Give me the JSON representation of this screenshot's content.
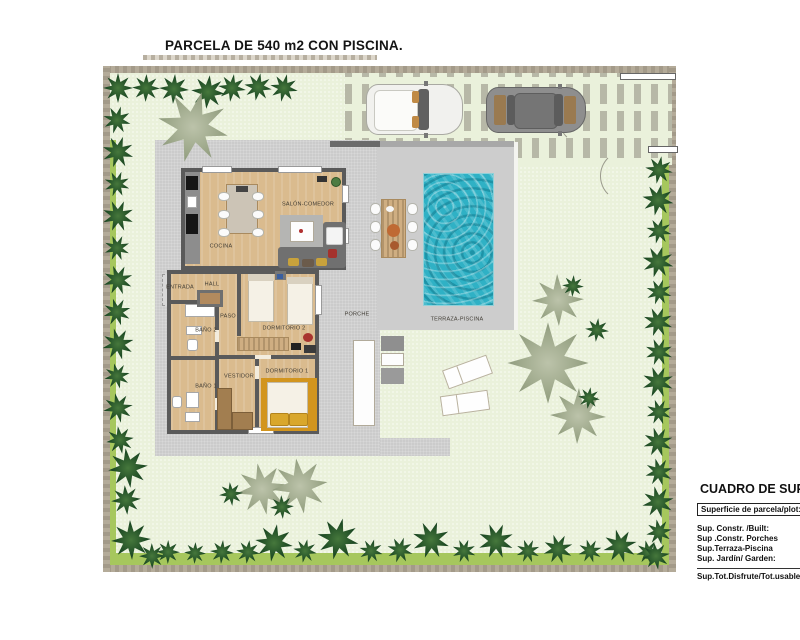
{
  "page": {
    "title": "PARCELA DE 540 m2 CON PISCINA."
  },
  "plan": {
    "rooms": [
      {
        "id": "cocina",
        "label": "COCINA"
      },
      {
        "id": "salon-comedor",
        "label": "SALÓN-COMEDOR"
      },
      {
        "id": "hall",
        "label": "HALL"
      },
      {
        "id": "entrada",
        "label": "ENTRADA"
      },
      {
        "id": "paso",
        "label": "PASO"
      },
      {
        "id": "bano-2",
        "label": "BAÑO 2"
      },
      {
        "id": "dormitorio-2",
        "label": "DORMITORIO 2"
      },
      {
        "id": "vestidor",
        "label": "VESTIDOR"
      },
      {
        "id": "dormitorio-1",
        "label": "DORMITORIO 1"
      },
      {
        "id": "bano-1",
        "label": "BAÑO 1"
      },
      {
        "id": "porche",
        "label": "PORCHE"
      },
      {
        "id": "terraza-piscina",
        "label": "TERRAZA-PISCINA"
      }
    ],
    "vehicles": [
      {
        "name": "white-car"
      },
      {
        "name": "dark-gray-car"
      }
    ]
  },
  "summary": {
    "title": "CUADRO DE SUPER",
    "plot_row": "Superficie de parcela/plot:",
    "rows": [
      "Sup. Constr. /Built:",
      "Sup .Constr. Porches",
      "Sup.Terraza-Piscina",
      "Sup. Jardín/ Garden:"
    ],
    "total_row": "Sup.Tot.Disfrute/Tot.usable"
  },
  "colors": {
    "pool": "#2fb1c5",
    "wood_floor": "#dabb8e",
    "terrace": "#cbcbcb",
    "garden": "#eaf1db",
    "grass_strip": "#a6c75d",
    "tree_dark": "#1d4a24",
    "tree_pale": "#9aa587",
    "rug_orange": "#d2951e"
  }
}
